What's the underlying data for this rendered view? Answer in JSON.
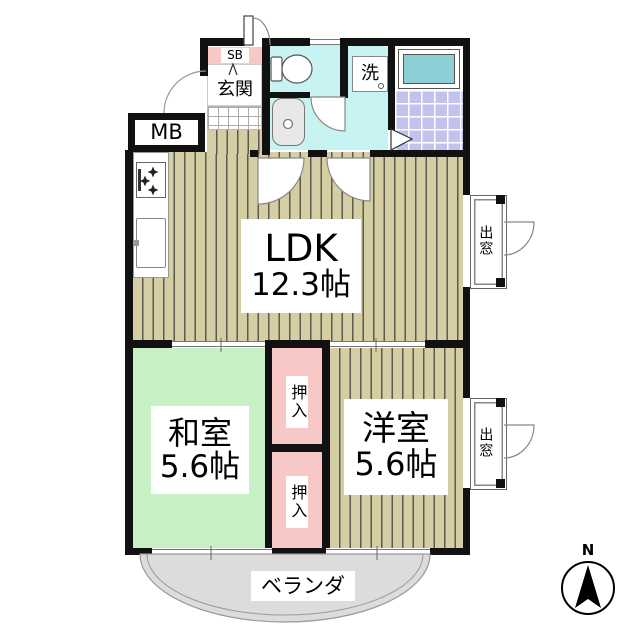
{
  "plan": {
    "rooms": {
      "ldk": {
        "name": "LDK",
        "size": "12.3帖"
      },
      "japanese_room": {
        "name": "和室",
        "size": "5.6帖"
      },
      "western_room": {
        "name": "洋室",
        "size": "5.6帖"
      },
      "entrance": {
        "name": "玄関"
      },
      "veranda": {
        "name": "ベランダ"
      }
    },
    "features": {
      "shoe_box": "SB",
      "meter_box": "MB",
      "washer": "洗",
      "closet_upper": "押入",
      "closet_lower": "押入",
      "bay_window_upper": "出窓",
      "bay_window_lower": "出窓"
    },
    "compass": {
      "north": "N"
    },
    "colors": {
      "wood_floor": "#d5cda4",
      "tatami_green": "#c7f1c5",
      "closet_pink": "#f8c8c6",
      "water_cyan": "#c7f3f2",
      "bathtub_teal": "#8ccfd4",
      "bath_tile_purple": "#c3c2ed",
      "veranda_gray": "#dcdcdc",
      "wall_black": "#111111"
    }
  }
}
